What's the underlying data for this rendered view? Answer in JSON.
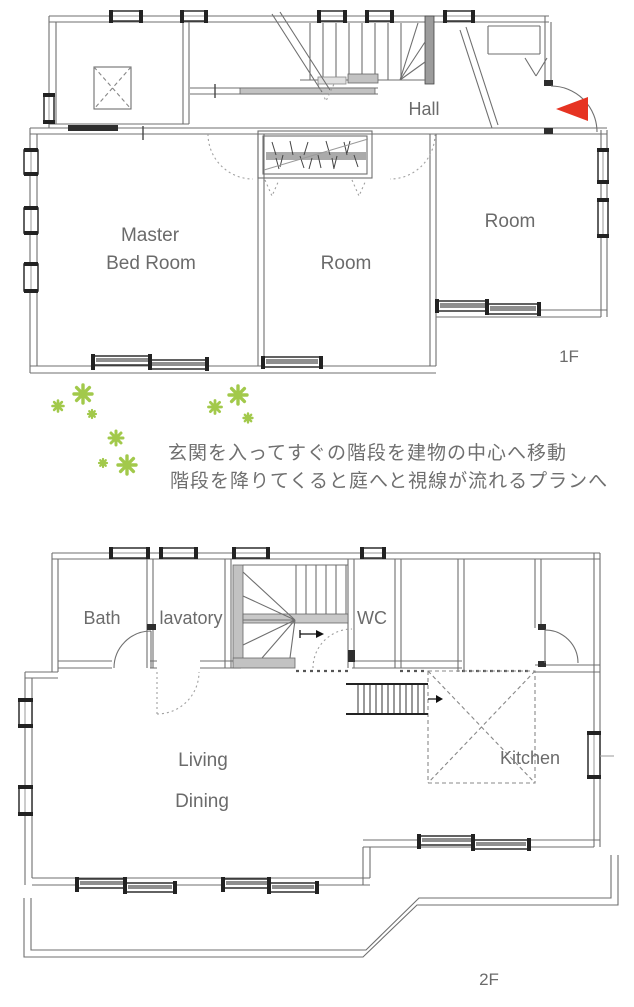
{
  "floor1": {
    "hall": "Hall",
    "master_line1": "Master",
    "master_line2": "Bed Room",
    "room_center": "Room",
    "room_right": "Room",
    "label": "1F"
  },
  "floor2": {
    "bath": "Bath",
    "lavatory": "lavatory",
    "wc": "WC",
    "living": "Living",
    "dining": "Dining",
    "kitchen": "Kitchen",
    "label": "2F"
  },
  "annotation": {
    "line1": "玄関を入ってすぐの階段を建物の中心へ移動",
    "line2": "階段を降りてくると庭へと視線が流れるプランへ"
  },
  "colors": {
    "wall": "#6f6f6f",
    "wall_dark": "#2e2e2e",
    "text": "#6b6b6b",
    "flower": "#a2c94b",
    "arrow_red": "#e63322",
    "stair_fill": "#c8c8c8"
  }
}
